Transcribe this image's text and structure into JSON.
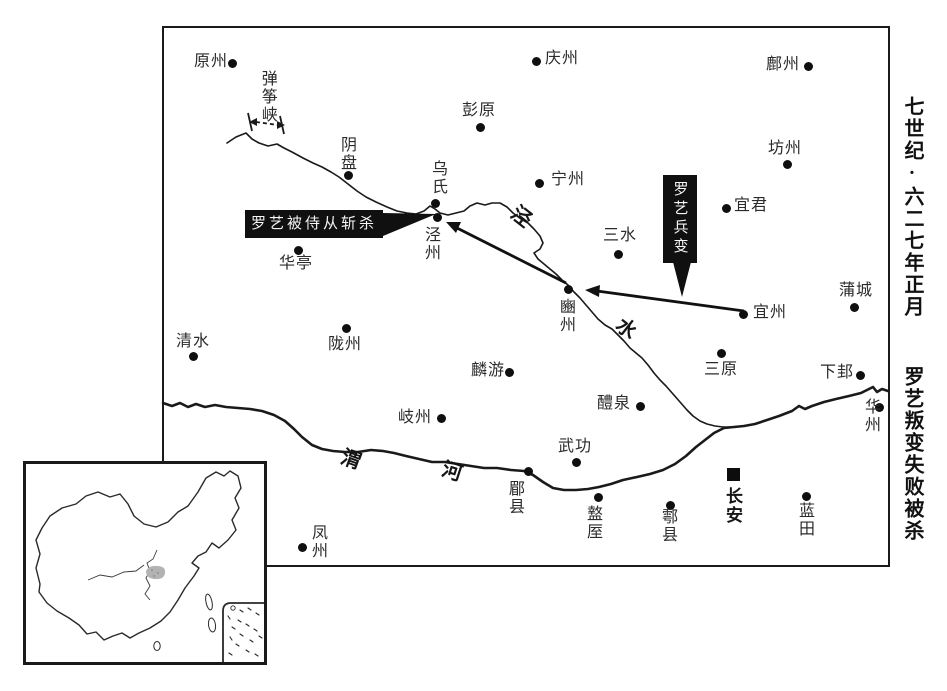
{
  "side_title": {
    "era": "七世纪·六二七年正月",
    "event": "罗艺叛变失败被杀"
  },
  "callouts": {
    "killed": "罗艺被侍从斩杀",
    "mutiny": "罗艺兵变"
  },
  "rivers": {
    "jing": {
      "c1": "泾",
      "c2": "水"
    },
    "wei": {
      "c1": "渭",
      "c2": "河"
    }
  },
  "gorge": {
    "name": "弹筝峡"
  },
  "capital": {
    "name": "长安",
    "marker": "black-square"
  },
  "colors": {
    "ink": "#1a1a1a",
    "callout_bg": "#101010",
    "highlight_gray": "#b3b3b3"
  },
  "cities": [
    {
      "name": "原州",
      "dot": [
        232,
        63
      ],
      "label": [
        194,
        54
      ],
      "dir": "h"
    },
    {
      "name": "庆州",
      "dot": [
        536,
        61
      ],
      "label": [
        545,
        51
      ],
      "dir": "h"
    },
    {
      "name": "鄜州",
      "dot": [
        808,
        66
      ],
      "label": [
        766,
        57
      ],
      "dir": "h"
    },
    {
      "name": "彭原",
      "dot": [
        480,
        127
      ],
      "label": [
        462,
        103
      ],
      "dir": "h"
    },
    {
      "name": "坊州",
      "dot": [
        787,
        164
      ],
      "label": [
        768,
        141
      ],
      "dir": "h"
    },
    {
      "name": "阴盘",
      "dot": [
        348,
        175
      ],
      "label": [
        337,
        136
      ],
      "dir": "v"
    },
    {
      "name": "乌氏",
      "dot": [
        435,
        203
      ],
      "label": [
        428,
        160
      ],
      "dir": "v"
    },
    {
      "name": "泾州",
      "dot": [
        437,
        217
      ],
      "label": [
        421,
        226
      ],
      "dir": "v"
    },
    {
      "name": "宁州",
      "dot": [
        539,
        183
      ],
      "label": [
        551,
        172
      ],
      "dir": "h"
    },
    {
      "name": "宜君",
      "dot": [
        726,
        208
      ],
      "label": [
        734,
        198
      ],
      "dir": "h"
    },
    {
      "name": "三水",
      "dot": [
        618,
        254
      ],
      "label": [
        603,
        228
      ],
      "dir": "h"
    },
    {
      "name": "华亭",
      "dot": [
        298,
        250
      ],
      "label": [
        279,
        256
      ],
      "dir": "h"
    },
    {
      "name": "豳州",
      "dot": [
        568,
        289
      ],
      "label": [
        556,
        298
      ],
      "dir": "v"
    },
    {
      "name": "宜州",
      "dot": [
        743,
        314
      ],
      "label": [
        753,
        305
      ],
      "dir": "h"
    },
    {
      "name": "蒲城",
      "dot": [
        854,
        307
      ],
      "label": [
        839,
        283
      ],
      "dir": "h"
    },
    {
      "name": "清水",
      "dot": [
        193,
        356
      ],
      "label": [
        176,
        334
      ],
      "dir": "h"
    },
    {
      "name": "陇州",
      "dot": [
        346,
        328
      ],
      "label": [
        328,
        337
      ],
      "dir": "h"
    },
    {
      "name": "三原",
      "dot": [
        721,
        353
      ],
      "label": [
        704,
        362
      ],
      "dir": "h"
    },
    {
      "name": "下邽",
      "dot": [
        860,
        375
      ],
      "label": [
        820,
        365
      ],
      "dir": "h"
    },
    {
      "name": "麟游",
      "dot": [
        509,
        372
      ],
      "label": [
        471,
        363
      ],
      "dir": "h"
    },
    {
      "name": "岐州",
      "dot": [
        441,
        418
      ],
      "label": [
        398,
        410
      ],
      "dir": "h"
    },
    {
      "name": "华州",
      "dot": [
        879,
        407
      ],
      "label": [
        861,
        398
      ],
      "dir": "v"
    },
    {
      "name": "醴泉",
      "dot": [
        640,
        406
      ],
      "label": [
        597,
        396
      ],
      "dir": "h"
    },
    {
      "name": "武功",
      "dot": [
        576,
        462
      ],
      "label": [
        558,
        439
      ],
      "dir": "h"
    },
    {
      "name": "郿县",
      "dot": [
        528,
        471
      ],
      "label": [
        505,
        480
      ],
      "dir": "v"
    },
    {
      "name": "盩厔",
      "dot": [
        598,
        497
      ],
      "label": [
        583,
        505
      ],
      "dir": "v"
    },
    {
      "name": "鄠县",
      "dot": [
        670,
        505
      ],
      "label": [
        658,
        508
      ],
      "dir": "v"
    },
    {
      "name": "蓝田",
      "dot": [
        806,
        496
      ],
      "label": [
        795,
        502
      ],
      "dir": "v"
    },
    {
      "name": "凤州",
      "dot": [
        302,
        547
      ],
      "label": [
        308,
        524
      ],
      "dir": "v"
    }
  ]
}
